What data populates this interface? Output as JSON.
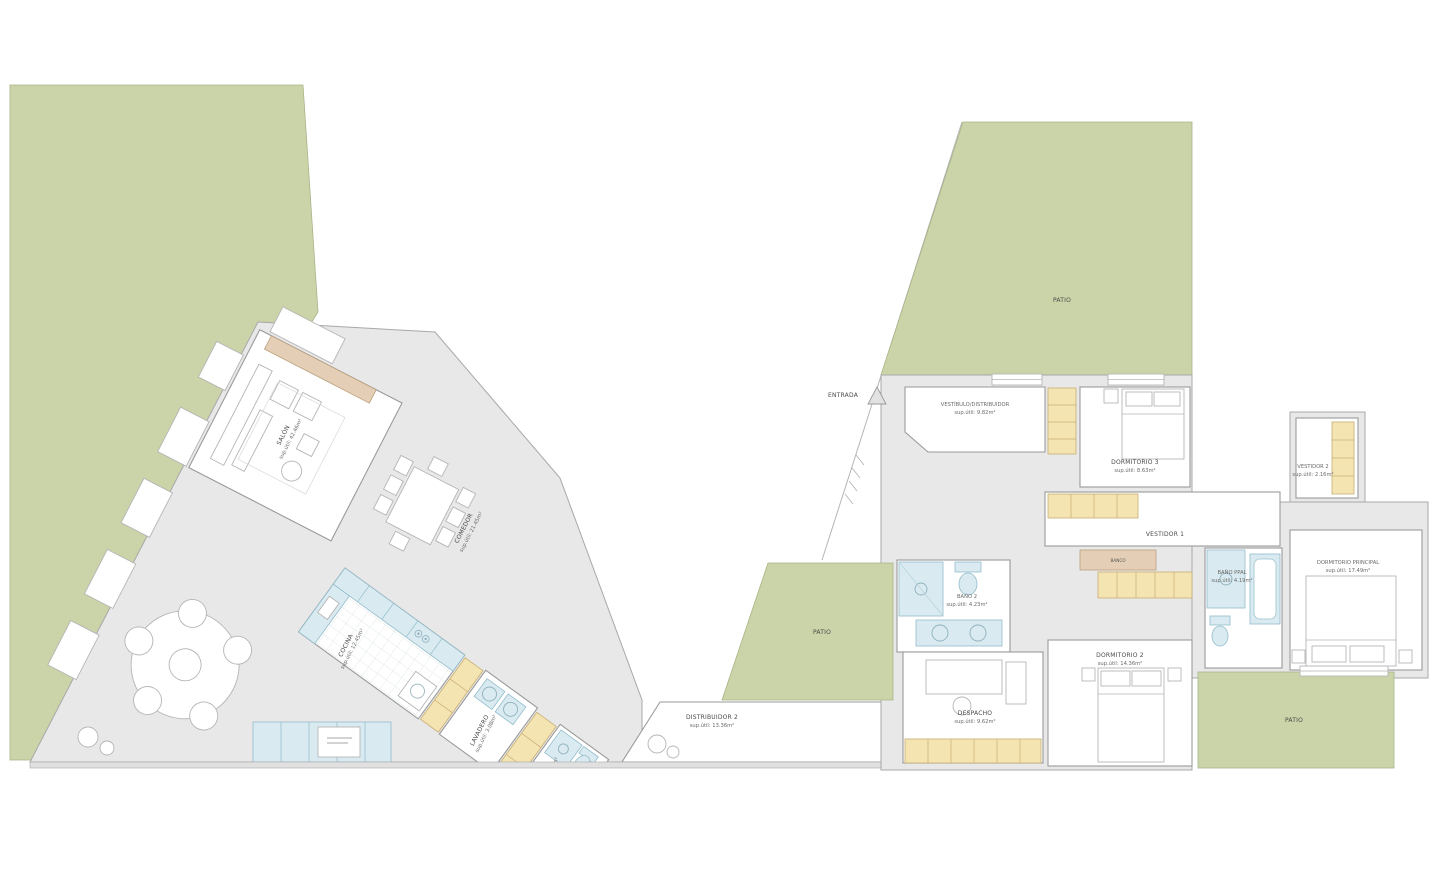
{
  "plan_title": "floor-plan",
  "colors": {
    "garden_green": "#cbd4a8",
    "floor_gray": "#e8e8e8",
    "room_white": "#ffffff",
    "wall_gray": "#9a9a9a",
    "wardrobe_yellow": "#f3e4b2",
    "fixture_cyan": "#d9ebf1",
    "wood_tan": "#e4cfb6"
  },
  "labels": {
    "entrance": "ENTRADA",
    "patio": "PATIO",
    "vestidor1": "VESTIDOR 1",
    "bench": "BANCO"
  },
  "rooms": {
    "salon": {
      "name": "SALÓN",
      "area": "sup.útil: 42.46m²"
    },
    "comedor": {
      "name": "COMEDOR",
      "area": "sup.útil: 21.45m²"
    },
    "cocina": {
      "name": "COCINA",
      "area": "sup.útil: 12.45m²"
    },
    "lavadero": {
      "name": "LAVADERO",
      "area": "sup.útil: 3.08m²"
    },
    "aseo": {
      "name": "ASEO",
      "area": "sup.útil: 2.46m²"
    },
    "distribuidor2": {
      "name": "DISTRIBUIDOR 2",
      "area": "sup.útil: 13.36m²"
    },
    "vestibulo": {
      "name": "VESTÍBULO/DISTRIBUIDOR",
      "area": "sup.útil: 9.82m²"
    },
    "dormitorio3": {
      "name": "DORMITORIO 3",
      "area": "sup.útil: 8.63m²"
    },
    "vestidor2": {
      "name": "VESTIDOR 2",
      "area": "sup.útil: 2.16m²"
    },
    "banoppal": {
      "name": "BAÑO PPAL",
      "area": "sup.útil: 4.19m²"
    },
    "dormppal": {
      "name": "DORMITORIO PRINCIPAL",
      "area": "sup.útil: 17.49m²"
    },
    "bano2": {
      "name": "BAÑO 2",
      "area": "sup.útil: 4.23m²"
    },
    "despacho": {
      "name": "DESPACHO",
      "area": "sup.útil: 9.62m²"
    },
    "dormitorio2": {
      "name": "DORMITORIO 2",
      "area": "sup.útil: 14.36m²"
    }
  }
}
